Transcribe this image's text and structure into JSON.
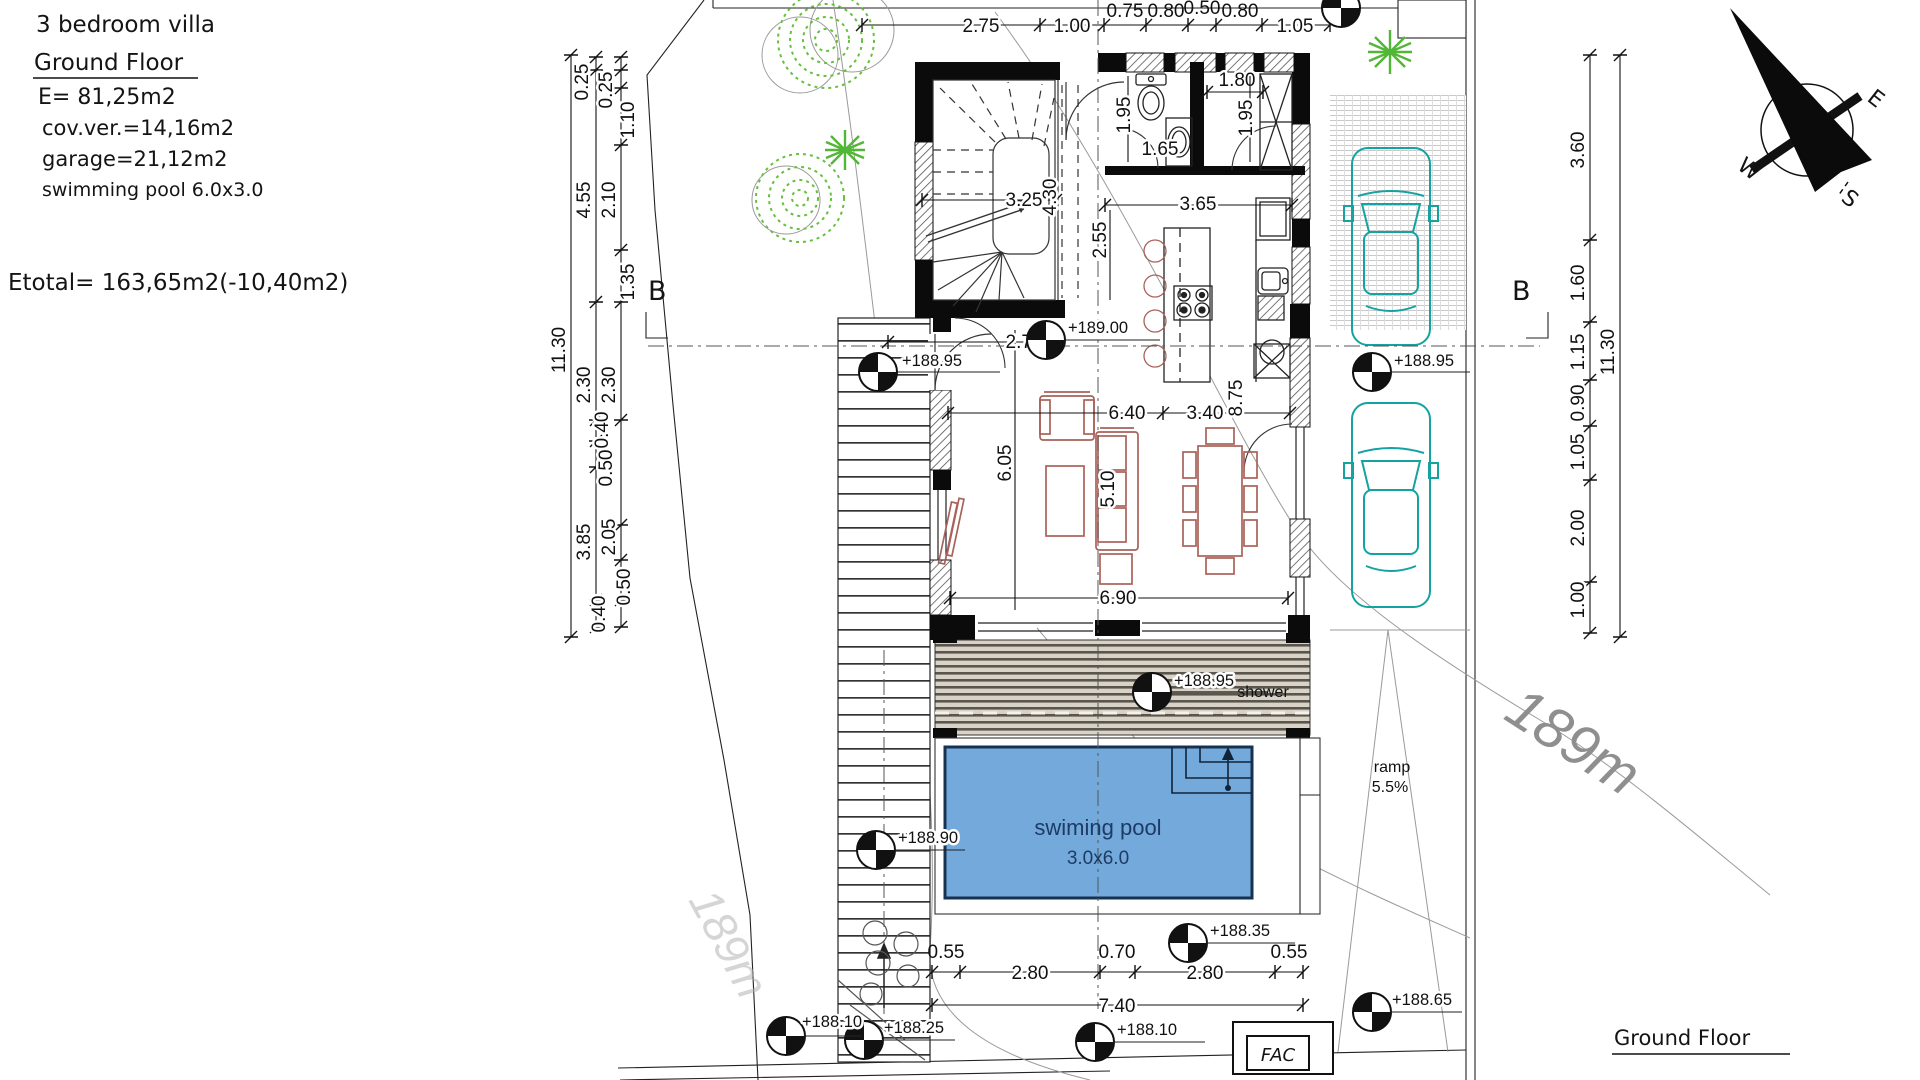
{
  "info_block": {
    "title": "3 bedroom villa",
    "section_title": "Ground Floor",
    "area_lines": [
      "E= 81,25m2",
      "cov.ver.=14,16m2",
      "garage=21,12m2",
      "swimming pool 6.0x3.0"
    ],
    "etotal_line": "Etotal= 163,65m2(-10,40m2)"
  },
  "footer": {
    "label": "Ground Floor"
  },
  "compass": {
    "east": "E",
    "west": "W",
    "south": "S"
  },
  "section_markers": {
    "left": "B",
    "right": "B"
  },
  "dims": {
    "top": [
      "2.75",
      "1.00",
      "0.75",
      "0.80",
      "0.50",
      "0.80",
      "1.05"
    ],
    "left": [
      "0.25",
      "0.25",
      "1.10",
      "4.55",
      "2.10",
      "1.35",
      "11.30",
      "2.30",
      "2.30",
      "0.40",
      "0.50",
      "3.85",
      "2.05",
      "0.50",
      "0.40"
    ],
    "right": [
      "3.60",
      "1.60",
      "1.15",
      "0.90",
      "1.05",
      "2.00",
      "1.00",
      "11.30"
    ],
    "bottom": [
      "0.55",
      "2.80",
      "0.70",
      "2.80",
      "0.55",
      "7.40"
    ],
    "interior": {
      "stair_width": "3.25",
      "stair_height": "4.30",
      "hall": "1.80",
      "bath_depth": "1.95",
      "basin": "1.65",
      "closet_depth": "1.95",
      "bath_width": "3.65",
      "kitchen_depth": "2.55",
      "kitchen_width": "3.40",
      "living_depth_right": "8.75",
      "living_width": "6.40",
      "living_depth": "6.05",
      "sofa_zone": "5.10",
      "terrace_width": "6.90",
      "entry": "2.75"
    }
  },
  "elevations": {
    "entry": "+188.95",
    "hall": "+189.00",
    "driveway": "+188.95",
    "deck": "+188.95",
    "walkway": "+188.90",
    "pool_side": "+188.35",
    "bottom_center": "+188.10",
    "bottom_mid": "+188.25",
    "bottom_left": "+188.10",
    "bottom_right": "+188.65"
  },
  "labels": {
    "pool_line1": "swiming pool",
    "pool_line2": "3.0x6.0",
    "shower": "shower",
    "ramp_line1": "ramp",
    "ramp_line2": "5.5%",
    "contour": "189m",
    "utility_box": "FAC"
  },
  "colors": {
    "pool_fill": "#74a9dc",
    "pool_text": "#1c3c66",
    "furniture": "#a8625a",
    "car": "#14a3a0",
    "tree": "#66bf3e",
    "deck_dark": "#5a564d",
    "deck_light": "#d8d3c6",
    "contour_text": "#8f8f8f"
  }
}
